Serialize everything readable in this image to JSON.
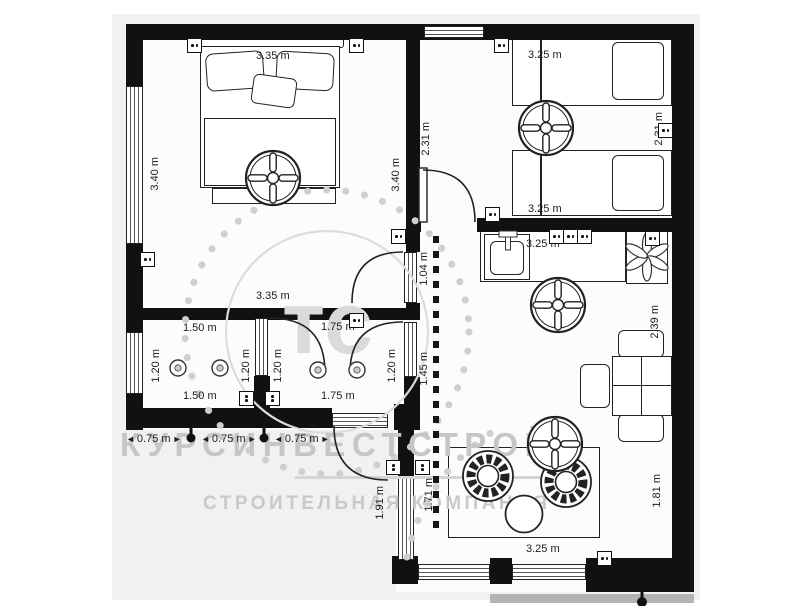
{
  "watermark": {
    "title": "КУРСИНВЕСТСТРОЙ",
    "subtitle": "СТРОИТЕЛЬНАЯ КОМПАНИЯ",
    "monogram": "тс"
  },
  "icons": {
    "arrow_left": "◄",
    "arrow_right": "►",
    "fan": "ceiling-fan",
    "sconce": "wall-lamp",
    "extractor": "extractor-fan"
  },
  "colors": {
    "wall": "#111111",
    "dim_text": "#1d1d1d",
    "watermark_gray": "#c6c6c6",
    "page_bg": "#f1f1ef"
  },
  "dims": {
    "master_top": "3.35 m",
    "master_bottom": "3.35 m",
    "master_left": "3.40 m",
    "master_right": "3.40 m",
    "twin_top": "3.25 m",
    "twin_bottom": "3.25 m",
    "twin_left": "2.31 m",
    "twin_right": "2.31 m",
    "kitchen_top": "3.25 m",
    "kitchen_right": "2.39 m",
    "corridor_upper": "1.04 m",
    "corridor_lower": "1.45 m",
    "w1_top": "1.50 m",
    "w1_bottom": "1.50 m",
    "w1_left": "1.20 m",
    "w1_right": "1.20 m",
    "w2_top": "1.75 m",
    "w2_bottom": "1.75 m",
    "w2_left": "1.20 m",
    "w2_right": "1.20 m",
    "porch_1": "0.75 m",
    "porch_2": "0.75 m",
    "porch_3": "0.75 m",
    "porch_depth": "1.91 m",
    "living_left": "1.71 m",
    "living_right": "1.81 m",
    "living_bottom": "3.25 m"
  }
}
